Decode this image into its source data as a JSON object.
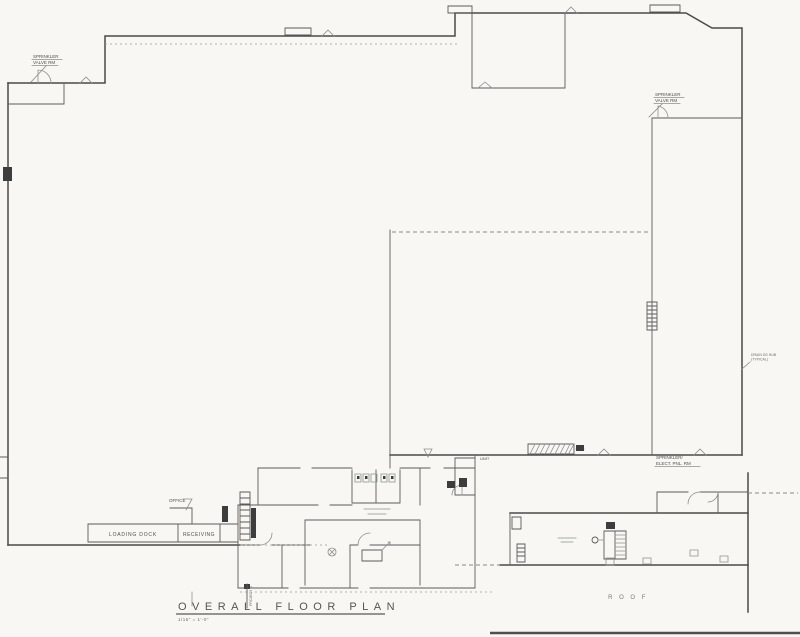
{
  "drawing": {
    "title_block": {
      "title": "OVERALL FLOOR PLAN",
      "scale": "1/16\" = 1'-0\""
    },
    "labels": {
      "sprinkler_valve_rm_left": {
        "line1": "SPRINKLER",
        "line2": "VALVE RM"
      },
      "sprinkler_valve_rm_right": {
        "line1": "SPRINKLER",
        "line2": "VALVE RM"
      },
      "sprinkler_elect_pnl_rm": {
        "line1": "SPRINKLER/",
        "line2": "ELECT. PNL. RM"
      },
      "office": "OFFICE",
      "loading_dock": "LOADING DOCK",
      "receiving": "RECEIVING",
      "unit": "UNIT",
      "roof": "R O O F",
      "drain_note": {
        "line1": "DRAIN DS HUB",
        "line2": "(TYPICAL)"
      },
      "project_north": "PROJECT N"
    },
    "colors": {
      "paper": "#f8f7f3",
      "ink": "#4a4a4a",
      "light_ink": "#8f8f8f"
    }
  }
}
